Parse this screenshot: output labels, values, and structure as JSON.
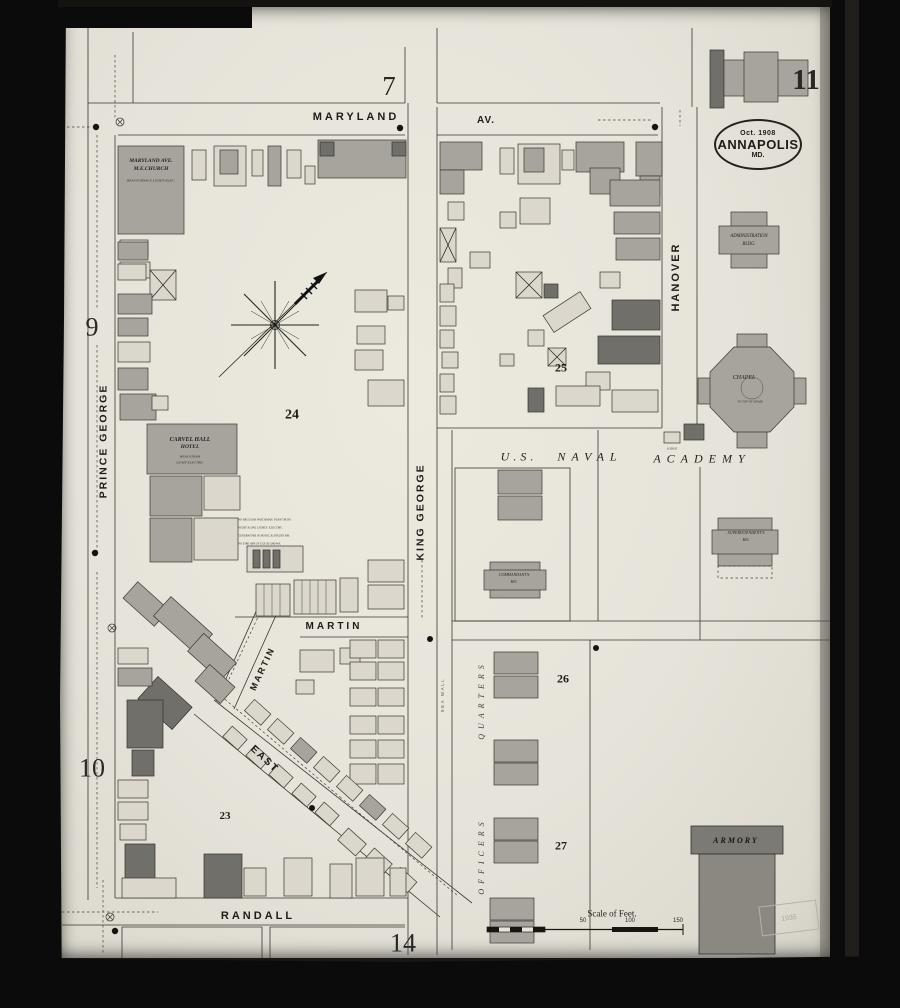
{
  "page": {
    "current": "11",
    "top": "7",
    "left_upper": "9",
    "left_lower": "10",
    "bottom": "14"
  },
  "stamp": {
    "date": "Oct. 1908",
    "city": "ANNAPOLIS",
    "state": "MD."
  },
  "streets": {
    "maryland": "MARYLAND",
    "maryland_av": "AV.",
    "prince_george": "PRINCE GEORGE",
    "king_george": "KING GEORGE",
    "hanover": "HANOVER",
    "martin": "MARTIN",
    "martin_diag": "MARTIN",
    "east": "EAST",
    "randall": "RANDALL"
  },
  "academy": {
    "us": "U.S.",
    "naval": "NAVAL",
    "academy": "ACADEMY",
    "officers": "OFFICERS",
    "quarters": "QUARTERS",
    "sea_wall": "SEA WALL"
  },
  "blocks": {
    "b23": "23",
    "b24": "24",
    "b25": "25",
    "b26": "26",
    "b27": "27"
  },
  "buildings": {
    "church_l1": "MARYLAND AVE.",
    "church_l2": "M.E.CHURCH",
    "church_note": "HEAT-FURNACE LIGHTS-ELEC.",
    "carvel_l1": "CARVEL HALL",
    "carvel_l2": "HOTEL",
    "carvel_note1": "HEAT-STEAM",
    "carvel_note2": "LIGHT-ELECTRIC",
    "admin_l1": "ADMINISTRATION",
    "admin_l2": "BLDG.",
    "chapel": "CHAPEL",
    "chapel_note": "TO TOP OF DOME",
    "superintendent_l1": "SUPERINTENDENT'S",
    "superintendent_l2": "HO.",
    "commandant_l1": "COMMANDANT'S",
    "commandant_l2": "HO.",
    "armory": "ARMORY",
    "lodge": "LODGE"
  },
  "notes": {
    "l1": "NO REGULAR WATCHMAN. PLANT RUNS",
    "l2": "NIGHT & DAY. LIGHTS: ELECTRIC.",
    "l3": "GENERATORS IN HOTEL & ENGINE RM.",
    "l4": "NO FIRE APP. IN USE AS SHOWN."
  },
  "scale": {
    "label": "Scale of Feet.",
    "t50": "50",
    "t100": "100",
    "t150": "150"
  },
  "faint_stamp": "1935",
  "colors": {
    "paper": "#e6e3da",
    "building_gray": "#a7a49d",
    "building_dark": "#716f6a",
    "building_light": "#dbd7cc",
    "line": "#3a3731",
    "film_black": "#0b0b0b"
  }
}
